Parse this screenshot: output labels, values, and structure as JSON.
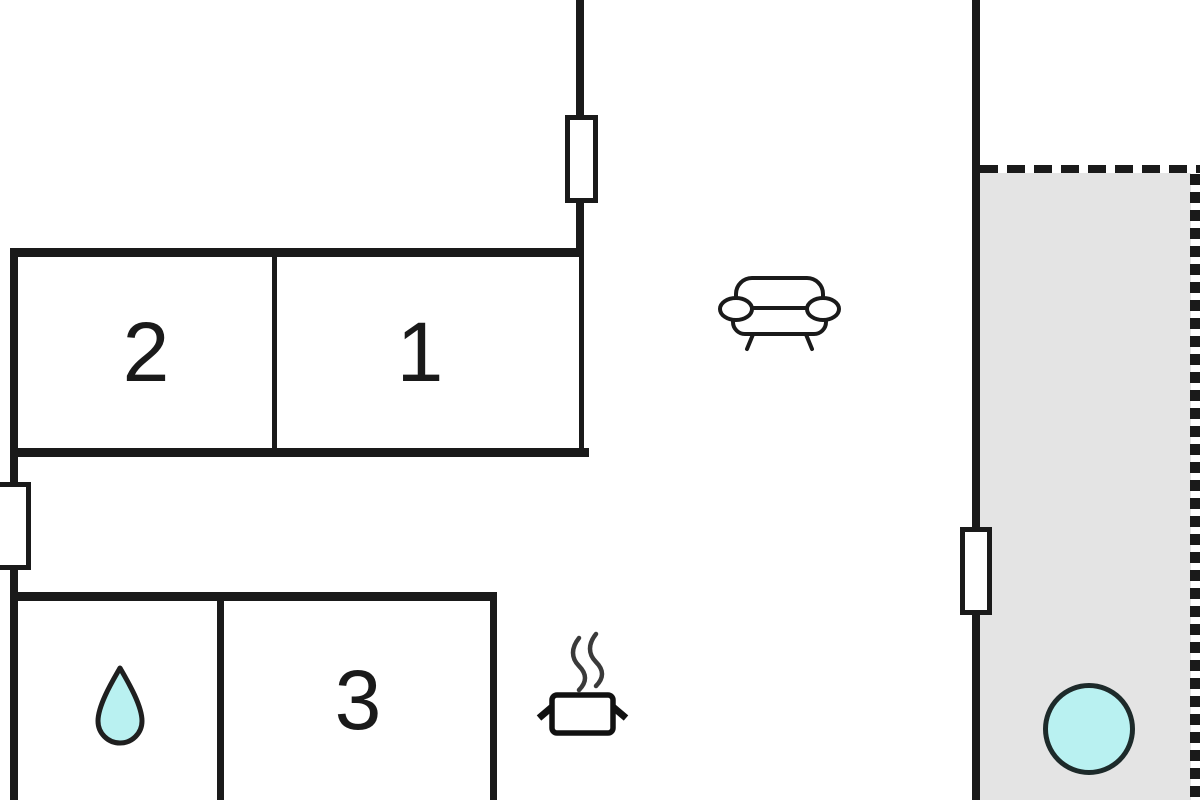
{
  "rooms": [
    {
      "label": "2"
    },
    {
      "label": "1"
    },
    {
      "label": "3"
    }
  ],
  "icons": [
    {
      "name": "water-drop-icon"
    },
    {
      "name": "cooking-pot-icon"
    },
    {
      "name": "sofa-icon"
    },
    {
      "name": "hot-tub-circle-icon"
    },
    {
      "name": "window-symbol"
    }
  ],
  "colors": {
    "wall": "#1a1a1a",
    "terrace_fill": "#e4e4e4",
    "water_fill": "#b9f1f1",
    "background": "#ffffff"
  }
}
